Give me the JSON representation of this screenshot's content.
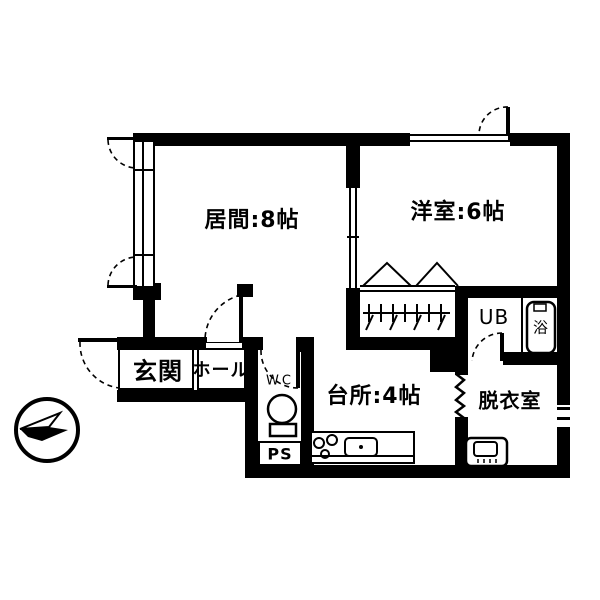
{
  "labels": {
    "living": "居間:8帖",
    "western": "洋室:6帖",
    "kitchen": "台所:4帖",
    "dressing": "脱衣室",
    "entrance": "玄関",
    "hall": "ホール",
    "wc": "WC",
    "ps": "PS",
    "unit_bath": "UB",
    "bath_tub": "浴"
  },
  "icons": {
    "compass": "north-arrow-compass",
    "toilet": "toilet-icon",
    "washing_machine": "washing-machine-icon",
    "bathtub": "bathtub-icon",
    "stove": "stove-burners-icon",
    "sink": "kitchen-sink-icon",
    "hangers": "clothes-hanger-rod-icon"
  },
  "colors": {
    "line": "#000000",
    "background": "#ffffff"
  }
}
